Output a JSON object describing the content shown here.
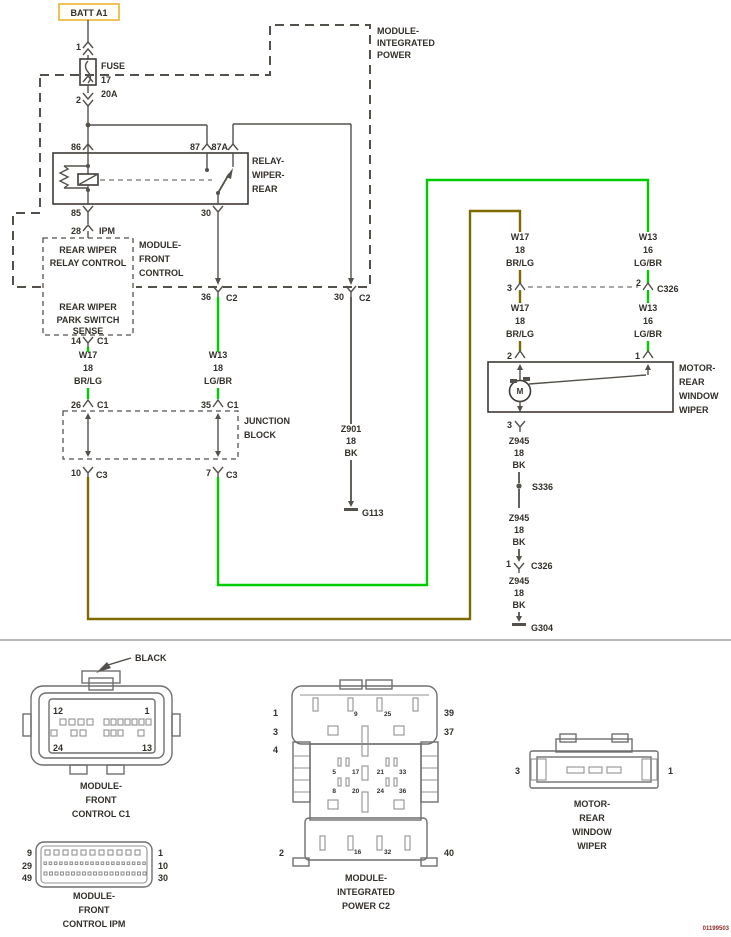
{
  "colors": {
    "green": "#00cc00",
    "olive": "#7d6a00",
    "wire": "#54504b",
    "text": "#332f2a",
    "batt_border": "#f0c25c",
    "connector": "#6f6f6f",
    "code": "#8b2a2a"
  },
  "top": {
    "batt": "BATT A1",
    "module_ip": {
      "l1": "MODULE-",
      "l2": "INTEGRATED",
      "l3": "POWER"
    },
    "fuse": {
      "pin1": "1",
      "pin2": "2",
      "name": "FUSE",
      "num": "17",
      "amp": "20A"
    }
  },
  "relay": {
    "p86": "86",
    "p87": "87",
    "p87a": "87A",
    "p85": "85",
    "p30": "30",
    "l1": "RELAY-",
    "l2": "WIPER-",
    "l3": "REAR"
  },
  "ipm_pin": {
    "num": "28",
    "name": "IPM"
  },
  "fcm": {
    "b1l1": "REAR WIPER",
    "b1l2": "RELAY CONTROL",
    "b2l1": "REAR WIPER",
    "b2l2": "PARK SWITCH",
    "b2l3": "SENSE",
    "l1": "MODULE-",
    "l2": "FRONT",
    "l3": "CONTROL",
    "pin14": "14",
    "c1": "C1",
    "pin36": "36",
    "c2a": "C2",
    "pin30": "30",
    "c2b": "C2"
  },
  "junction": {
    "l1": "JUNCTION",
    "l2": "BLOCK",
    "pin26": "26",
    "c1a": "C1",
    "pin35": "35",
    "c1b": "C1",
    "pin10": "10",
    "c3a": "C3",
    "pin7": "7",
    "c3b": "C3"
  },
  "wires": {
    "w17a": {
      "n": "W17",
      "g": "18",
      "c": "BR/LG"
    },
    "w13a": {
      "n": "W13",
      "g": "18",
      "c": "LG/BR"
    },
    "w17b": {
      "n": "W17",
      "g": "18",
      "c": "BR/LG"
    },
    "w13b": {
      "n": "W13",
      "g": "16",
      "c": "LG/BR"
    },
    "w17c": {
      "n": "W17",
      "g": "18",
      "c": "BR/LG"
    },
    "w13c": {
      "n": "W13",
      "g": "16",
      "c": "LG/BR"
    },
    "z901": {
      "n": "Z901",
      "g": "18",
      "c": "BK"
    },
    "z945a": {
      "n": "Z945",
      "g": "18",
      "c": "BK"
    },
    "z945b": {
      "n": "Z945",
      "g": "18",
      "c": "BK"
    },
    "z945c": {
      "n": "Z945",
      "g": "18",
      "c": "BK"
    }
  },
  "c326": {
    "p3": "3",
    "p2": "2",
    "name": "C326",
    "p1": "1",
    "name2": "C326"
  },
  "motor": {
    "l1": "MOTOR-",
    "l2": "REAR",
    "l3": "WINDOW",
    "l4": "WIPER",
    "m": "M",
    "p2": "2",
    "p1": "1",
    "p3": "3"
  },
  "grounds": {
    "g113": "G113",
    "s336": "S336",
    "g304": "G304"
  },
  "connectors": {
    "c1": {
      "black": "BLACK",
      "tl": "12",
      "tr": "1",
      "bl": "24",
      "br": "13",
      "cap1": "MODULE-",
      "cap2": "FRONT",
      "cap3": "CONTROL C1"
    },
    "c2": {
      "left": [
        "1",
        "3",
        "4"
      ],
      "right": [
        "39",
        "37"
      ],
      "bl": "2",
      "br": "40",
      "i9": "9",
      "i25": "25",
      "i5": "5",
      "i17": "17",
      "i21": "21",
      "i33": "33",
      "i8": "8",
      "i20": "20",
      "i24": "24",
      "i36": "36",
      "i16": "16",
      "i32": "32",
      "cap1": "MODULE-",
      "cap2": "INTEGRATED",
      "cap3": "POWER C2"
    },
    "motor": {
      "l": "3",
      "r": "1",
      "cap1": "MOTOR-",
      "cap2": "REAR",
      "cap3": "WINDOW",
      "cap4": "WIPER"
    },
    "ipm": {
      "left": [
        "9",
        "29",
        "49"
      ],
      "right": [
        "1",
        "10",
        "30"
      ],
      "cap1": "MODULE-",
      "cap2": "FRONT",
      "cap3": "CONTROL IPM"
    }
  },
  "code": "01199503"
}
